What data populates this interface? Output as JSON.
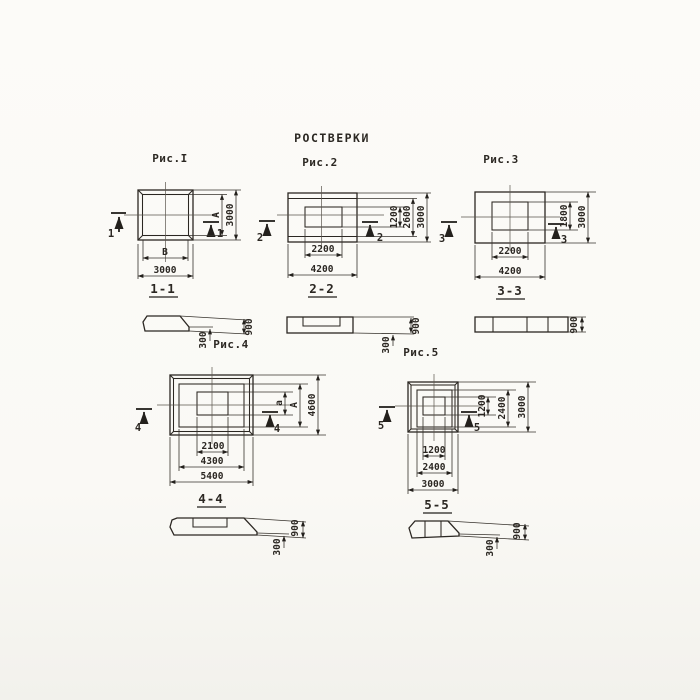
{
  "page": {
    "title": "РОСТВЕРКИ"
  },
  "colors": {
    "ink": "#2b2722",
    "paper": "#fbfaf6"
  },
  "fig1": {
    "title": "Рис.I",
    "cut": "1",
    "dim_inner_width": "В",
    "dim_outer_width": "3000",
    "dim_inner_height": "А",
    "dim_outer_height": "3000",
    "section_title": "1-1"
  },
  "fig2": {
    "title": "Рис.2",
    "cut": "2",
    "dims_bottom": [
      "2200",
      "4200"
    ],
    "dims_right": [
      "1200",
      "2600",
      "3000"
    ],
    "section_title": "2-2"
  },
  "fig3": {
    "title": "Рис.3",
    "cut": "3",
    "dims_bottom": [
      "2200",
      "4200"
    ],
    "dims_right": [
      "1800",
      "3000"
    ],
    "section_title": "3-3"
  },
  "fig4": {
    "title": "Рис.4",
    "cut": "4",
    "dims_bottom": [
      "2100",
      "4300",
      "5400"
    ],
    "dims_right": [
      "а",
      "А",
      "4600"
    ],
    "section_title": "4-4"
  },
  "fig5": {
    "title": "Рис.5",
    "cut": "5",
    "dims_bottom": [
      "1200",
      "2400",
      "3000"
    ],
    "dims_right": [
      "1200",
      "2400",
      "3000"
    ],
    "section_title": "5-5"
  },
  "sections": {
    "s1": {
      "thickness": "300",
      "height": "900"
    },
    "s2": {
      "thickness": "300",
      "height": "900"
    },
    "s3": {
      "height": "900"
    },
    "s4": {
      "thickness": "300",
      "height": "900"
    },
    "s5": {
      "thickness": "300",
      "height": "900"
    }
  }
}
